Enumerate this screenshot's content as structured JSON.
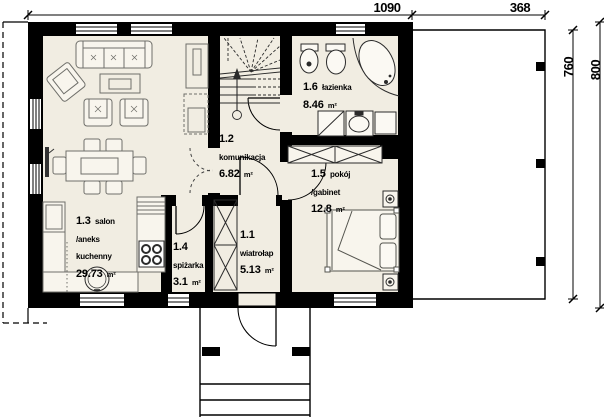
{
  "plan_title": "parter - rzut",
  "dimensions": {
    "top": [
      {
        "label": "1090"
      },
      {
        "label": "368"
      }
    ],
    "right": [
      {
        "label": "760"
      },
      {
        "label": "800"
      }
    ]
  },
  "rooms": {
    "wiatrolap": {
      "number": "1.1",
      "name": "wiatrołap",
      "area": "5.13",
      "unit": "m²"
    },
    "komunikacja": {
      "number": "1.2",
      "name": "komunikacja",
      "area": "6.82",
      "unit": "m²"
    },
    "salon": {
      "number": "1.3",
      "name": "salon /aneks kuchenny",
      "area": "29.73",
      "unit": "m²"
    },
    "spizarka": {
      "number": "1.4",
      "name": "spiżarka",
      "area": "3.1",
      "unit": "m²"
    },
    "pokoj": {
      "number": "1.5",
      "name": "pokój /gabinet",
      "area": "12.8",
      "unit": "m²"
    },
    "lazienka": {
      "number": "1.6",
      "name": "łazienka",
      "area": "8.46",
      "unit": "m²"
    }
  },
  "colors": {
    "wall": "#000000",
    "floor": "#f1ede2",
    "furniture_line": "#6f6f6a",
    "fixture_line": "#2b2b2b"
  }
}
